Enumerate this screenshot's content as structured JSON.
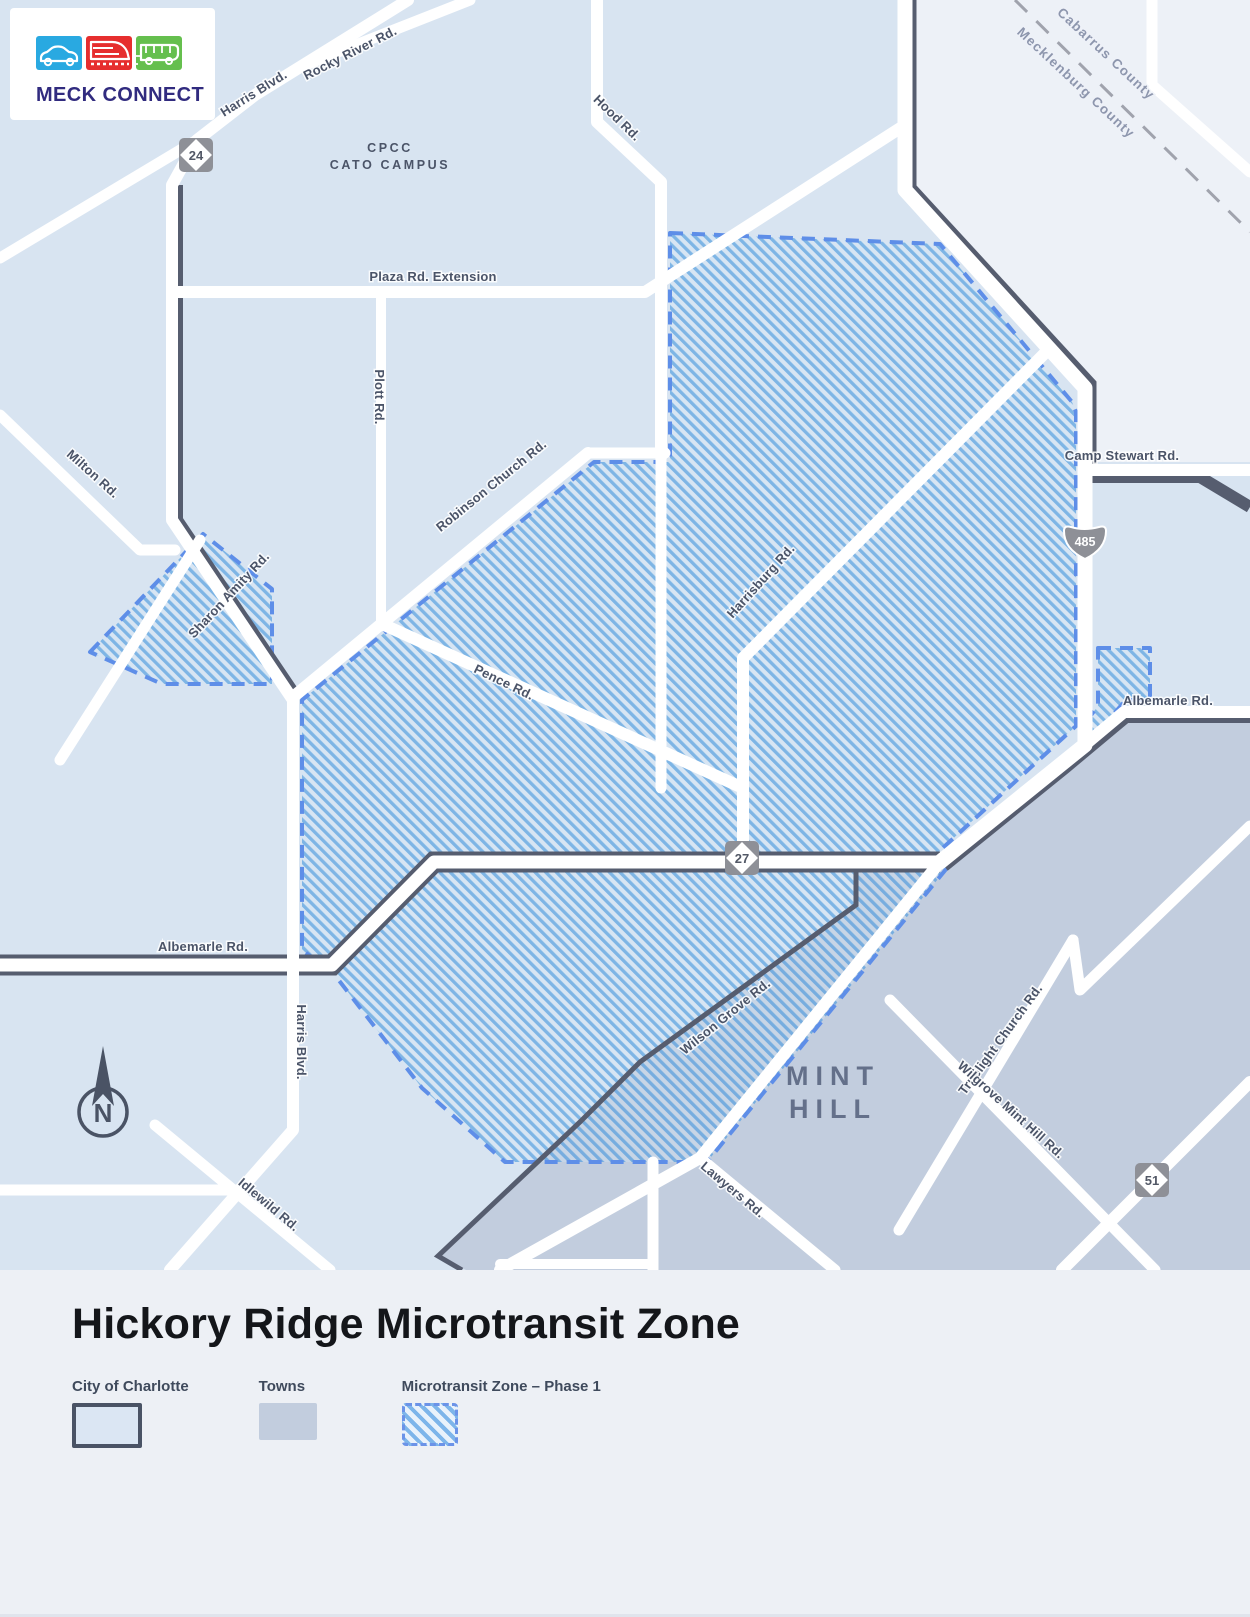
{
  "logo": {
    "text": "MECK CONNECT",
    "tile_colors": {
      "car": "#29A9E1",
      "train": "#E62E2E",
      "bus": "#65BF4E"
    },
    "text_color": "#312B7F"
  },
  "map": {
    "counties": {
      "cabarrus": "Cabarrus County",
      "mecklenburg": "Mecklenburg County"
    },
    "campus": {
      "line1": "CPCC",
      "line2": "CATO CAMPUS"
    },
    "town": {
      "line1": "MINT",
      "line2": "HILL"
    },
    "compass": "N",
    "shields": {
      "nc24": "24",
      "nc27": "27",
      "nc51": "51",
      "i485": "485"
    },
    "roads": {
      "harris_blvd_north": "Harris Blvd.",
      "rocky_river": "Rocky River Rd.",
      "hood": "Hood Rd.",
      "plaza_extension": "Plaza Rd. Extension",
      "plott": "Plott Rd.",
      "robinson_church": "Robinson Church Rd.",
      "milton": "Milton Rd.",
      "sharon_amity": "Sharon Amity Rd.",
      "pence": "Pence Rd.",
      "harrisburg": "Harrisburg Rd.",
      "camp_stewart": "Camp Stewart Rd.",
      "albemarle_east": "Albemarle Rd.",
      "albemarle_west": "Albemarle Rd.",
      "harris_blvd_south": "Harris Blvd.",
      "idlewild": "Idlewild Rd.",
      "wilson_grove": "Wilson Grove Rd.",
      "truelight_church": "Truelight Church Rd.",
      "wilgrove_mint_hill": "Wilgrove Mint Hill Rd.",
      "lawyers": "Lawyers Rd."
    }
  },
  "footer": {
    "title": "Hickory Ridge Microtransit Zone",
    "legend": [
      {
        "label": "City of Charlotte",
        "swatch": "city"
      },
      {
        "label": "Towns",
        "swatch": "towns"
      },
      {
        "label": "Microtransit Zone – Phase 1",
        "swatch": "hatch"
      }
    ]
  },
  "colors": {
    "city_fill": "#D8E4F1",
    "outside_county_fill": "#EDF1F7",
    "town_fill": "#C2CDDE",
    "zone_stripe": "#3E8EDC",
    "zone_border": "#5E8EE8",
    "city_boundary": "#565D6F",
    "road": "#FFFFFF",
    "label": "#4B5468",
    "footer_bg": "#EDF0F5"
  }
}
